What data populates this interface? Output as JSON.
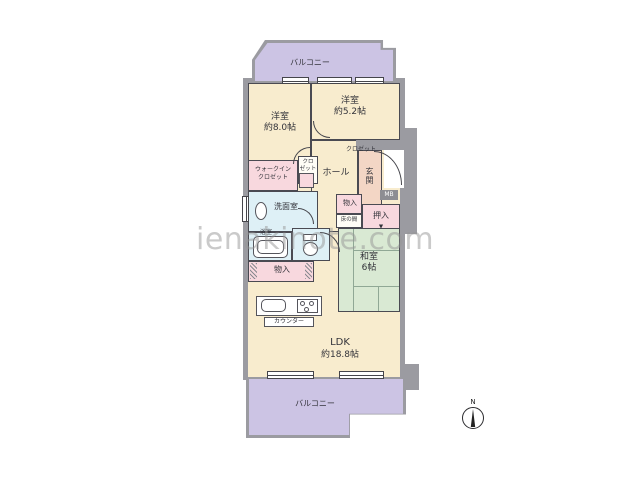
{
  "watermark": "ienakinote.com",
  "compass": {
    "north": "N"
  },
  "plan": {
    "balcony_top_label": "バルコニー",
    "balcony_bottom_label": "バルコニー",
    "bedroom_left": {
      "name": "洋室",
      "size": "約8.0帖"
    },
    "bedroom_right": {
      "name": "洋室",
      "size": "約5.2帖"
    },
    "closet_right": "クロゼット",
    "walkin_closet": {
      "line1": "ウォークイン",
      "line2": "クロゼット"
    },
    "small_closet": {
      "line1": "クロ",
      "line2": "ゼット"
    },
    "hall": "ホール",
    "genkan": "玄関",
    "mb": "MB",
    "washroom": "洗面室",
    "bathroom": "浴室",
    "storage_hall": "物入",
    "storage_ldk": "物入",
    "tokonoma": "床の間",
    "oshiire": "押入",
    "oshiire_marker": "▼",
    "washitsu": {
      "name": "和室",
      "size": "6帖"
    },
    "ldk": {
      "name": "LDK",
      "size": "約18.8帖"
    },
    "counter": "カウンター"
  },
  "colors": {
    "wall_gray": "#9b9ba1",
    "room_cream": "#f8ecce",
    "closet_pink": "#f8d8de",
    "wet_blue": "#def0f6",
    "tatami_green": "#d9e9d3",
    "genkan_peach": "#f3d6c5",
    "balcony": "#ccc4e4"
  }
}
